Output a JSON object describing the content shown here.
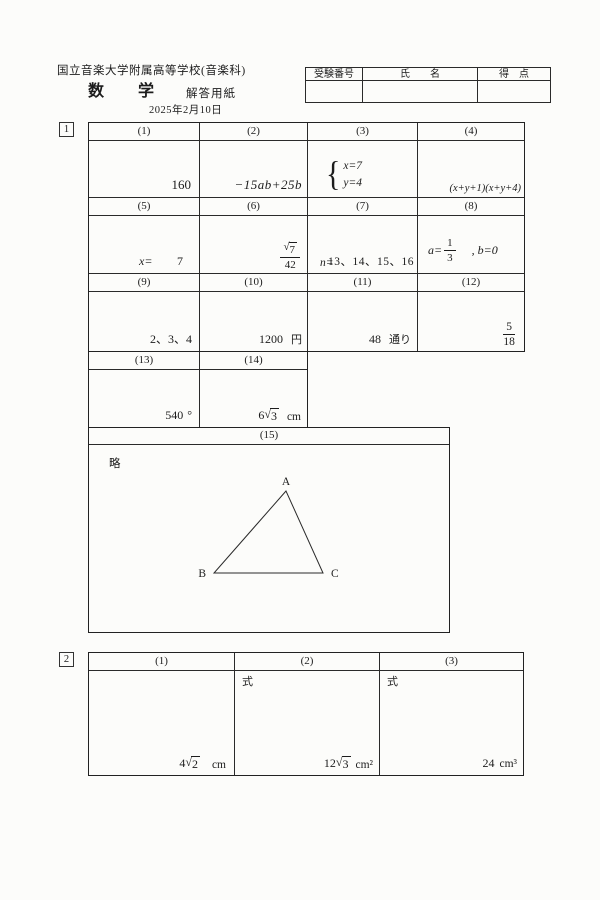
{
  "header": {
    "school": "国立音楽大学附属高等学校(音楽科)",
    "subject": "数学",
    "sheet_type": "解答用紙",
    "date": "2025年2月10日"
  },
  "info_table": {
    "exam_no_label": "受験番号",
    "name_label": "氏　　名",
    "score_label": "得　点"
  },
  "symbols": {
    "sqrt": "√",
    "brace": "{"
  },
  "section1": {
    "number": "1",
    "q1": {
      "label": "(1)",
      "answer": "160"
    },
    "q2": {
      "label": "(2)",
      "answer": "−15ab+25b"
    },
    "q3": {
      "label": "(3)",
      "line1": "x=7",
      "line2": "y=4"
    },
    "q4": {
      "label": "(4)",
      "answer": "(x+y+1)(x+y+4)"
    },
    "q5": {
      "label": "(5)",
      "prefix": "x=",
      "answer": "7"
    },
    "q6": {
      "label": "(6)",
      "num_radicand": "7",
      "den": "42"
    },
    "q7": {
      "label": "(7)",
      "prefix": "n=",
      "answer": "13、14、15、16"
    },
    "q8": {
      "label": "(8)",
      "a_prefix": "a=",
      "num": "1",
      "den": "3",
      "b_text": ", b=0"
    },
    "q9": {
      "label": "(9)",
      "answer": "2、3、4"
    },
    "q10": {
      "label": "(10)",
      "answer": "1200",
      "unit": "円"
    },
    "q11": {
      "label": "(11)",
      "answer": "48",
      "unit": "通り"
    },
    "q12": {
      "label": "(12)",
      "num": "5",
      "den": "18"
    },
    "q13": {
      "label": "(13)",
      "answer": "540",
      "unit": "°"
    },
    "q14": {
      "label": "(14)",
      "coef": "6",
      "radicand": "3",
      "unit": "cm"
    },
    "q15": {
      "label": "(15)",
      "note": "略",
      "vertex_a": "A",
      "vertex_b": "B",
      "vertex_c": "C"
    }
  },
  "section2": {
    "number": "2",
    "q1": {
      "label": "(1)",
      "coef": "4",
      "radicand": "2",
      "unit": "cm"
    },
    "q2": {
      "label": "(2)",
      "formula_label": "式",
      "coef": "12",
      "radicand": "3",
      "unit": "cm²"
    },
    "q3": {
      "label": "(3)",
      "formula_label": "式",
      "answer": "24",
      "unit": "cm³"
    }
  }
}
